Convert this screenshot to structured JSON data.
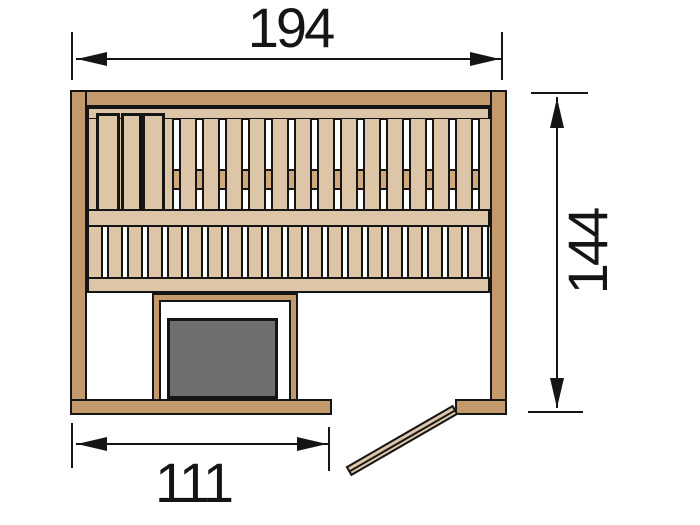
{
  "dimensions": {
    "top": {
      "value": "194"
    },
    "right": {
      "value": "144"
    },
    "bottom": {
      "value": "111"
    }
  },
  "colors": {
    "wood_wall": "#c49a6c",
    "wood_light": "#dcc6a7",
    "wood_rail": "#cfa87c",
    "heater_gray": "#6f6f6f",
    "ink": "#151515",
    "bg": "#ffffff"
  }
}
